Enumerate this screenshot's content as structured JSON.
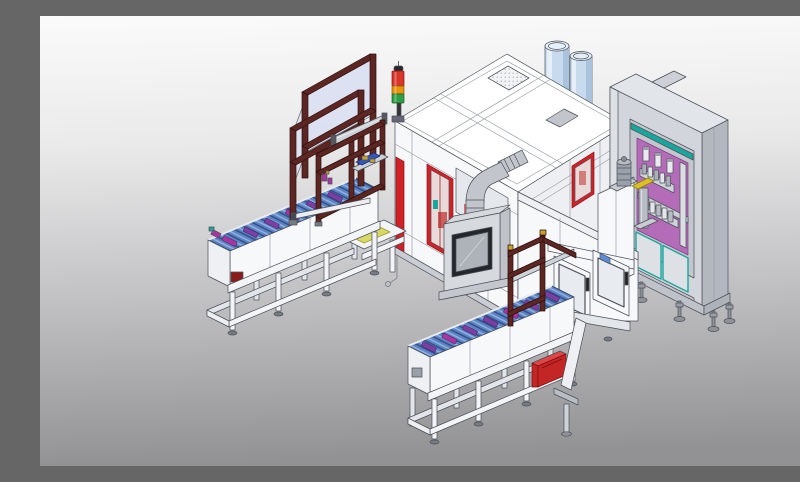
{
  "scene": {
    "aria_label": "Isometric 3D CAD rendering of an automated production line: two blue roller conveyors carrying purple parts, a maroon pick-and-place gantry station with a red-amber-green signal tower, a large white process enclosure with red access doors, an exhaust duct elbow, an HMI viewing box, two light-blue buffer tanks, a white operator enclosure with windowed doors, and a gray electrical control cabinet with a purple pneumatic valve panel, teal doors and leveling feet",
    "components": [
      "pick-and-place-gantry-frame",
      "safety-glass-panels",
      "signal-tower-light",
      "infeed-roller-conveyor",
      "outfeed-roller-conveyor",
      "conveyor-parts",
      "support-tables-with-leveling-feet",
      "main-process-enclosure",
      "red-access-doors",
      "roof-vent-panel",
      "exhaust-duct-elbow",
      "hmi-viewing-box",
      "buffer-tanks",
      "operator-enclosure-doors",
      "electrical-control-cabinet",
      "pneumatic-valve-panel",
      "cabinet-teal-doors",
      "red-drive-motor",
      "wall-mounted-motor",
      "cylinder-unit-yellow-cap"
    ]
  },
  "colors": {
    "bg_top": "#fbfbfb",
    "bg_upper": "#e9e9ea",
    "bg_lower": "#bfbfc1",
    "bg_bottom": "#929294",
    "outline": "#4b5058",
    "panel_bright": "#ffffff",
    "panel_white": "#f7f8fa",
    "panel_shade": "#e4e7ec",
    "panel_side": "#edeff3",
    "base_gray": "#c9ccd2",
    "red_accent": "#cf2128",
    "red_dark": "#8a1515",
    "glass_pink": "#e9d9d8",
    "interior_red": "#c24040",
    "teal_accent": "#1ba69d",
    "duct_gray": "#c2c6cc",
    "box_gray": "#d6d9dd",
    "box_side": "#bfc3c9",
    "window_frame": "#23262b",
    "window_glass": "#aeb3ba",
    "tank_blue": "#c8daee",
    "tank_shade": "#a9c2dd",
    "tank_top": "#e6eff9",
    "cabinet_face": "#d2d5db",
    "cabinet_side": "#b3b7be",
    "cabinet_top": "#e2e5ea",
    "cabinet_inner": "#c3c7cd",
    "cabinet_trim": "#dde0e5",
    "purple_panel": "#b56cb8",
    "purple_dark": "#7e3f84",
    "lavender": "#dbe1f3",
    "maroon": "#5c2623",
    "maroon_dark": "#2f0f0d",
    "roller_blue": "#5b84c4",
    "roller_gap": "#35518a",
    "roller_hl": "#8fb0de",
    "item_purple": "#7a3fa3",
    "item_magenta": "#a835a0",
    "table_white": "#f3f4f7",
    "table_shade": "#e2e5ea",
    "rail_silver": "#ced3da",
    "yellow_green": "#d8d965",
    "gold": "#c9a22a",
    "signal_red": "#d8352b",
    "signal_amber": "#e8930c",
    "signal_green": "#2f9e44",
    "signal_dark": "#26282c",
    "motor_gray": "#9ba1ab",
    "yellow_cap": "#d9c11f",
    "comp_blue": "#3558b8",
    "red_motor": "#c42525",
    "foot_gray": "#8e9298",
    "seam": "#9aa0a8"
  }
}
